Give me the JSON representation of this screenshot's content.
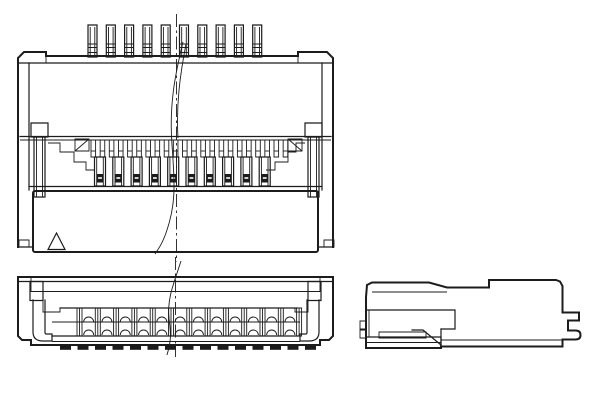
{
  "drawing": {
    "background": "#ffffff",
    "line_color": "#1c1c1c",
    "views": {
      "front": {
        "name": "front-elevation-with-partial-break",
        "pins": {
          "count": 10,
          "first_x": 88,
          "pitch": 18.3,
          "width": 9,
          "top": 25,
          "bottom": 57
        },
        "teeth": {
          "count": 22,
          "first_x": 91,
          "pitch": 9.15,
          "width": 4.6,
          "top": 140,
          "bottom": 157
        },
        "fingers": {
          "count": 10,
          "first_x": 94.5,
          "pitch": 18.3,
          "width": 11,
          "top": 157,
          "bottom": 186
        }
      },
      "bottom": {
        "name": "mating-face-view",
        "bars": {
          "count": 13,
          "first_x": 77,
          "pitch": 18.3,
          "width": 5,
          "top": 308,
          "bottom": 336
        },
        "domes": {
          "count": 12,
          "radius": 5,
          "upper_base_y": 322,
          "lower_base_y": 335
        },
        "dashes": {
          "count": 15,
          "first_x": 60,
          "pitch": 17.5,
          "width": 11,
          "height": 4,
          "y": 345.8
        }
      },
      "side": {
        "name": "side-profile-view"
      }
    }
  }
}
